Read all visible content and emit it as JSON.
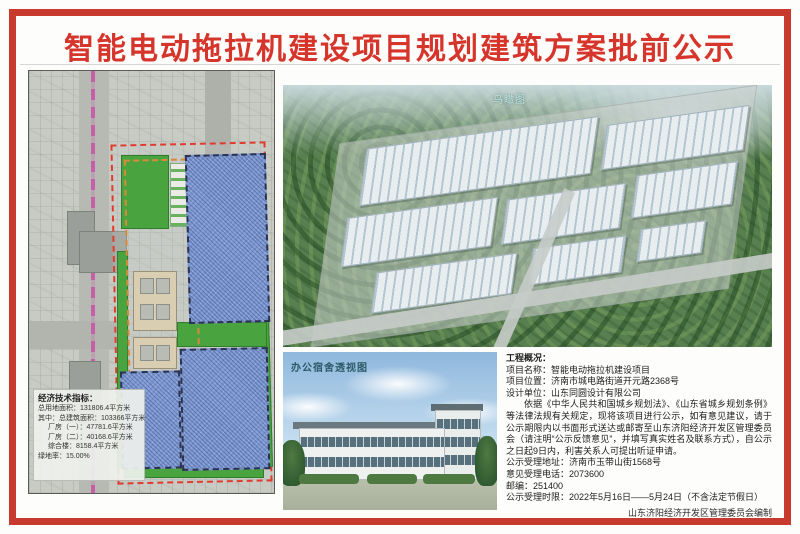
{
  "title": "智能电动拖拉机建设项目规划建筑方案批前公示",
  "site_plan": {
    "legend_title": "经济技术指标：",
    "legend_lines": [
      "总用地面积：131806.4平方米",
      "其中：总建筑面积：103366平方米",
      "厂房（一）：47781.6平方米",
      "厂房（二）：40168.6平方米",
      "综合楼：8158.4平方米",
      "绿地率：15.00%"
    ]
  },
  "aerial": {
    "label": "鸟瞰图"
  },
  "perspective": {
    "label": "办公宿舍透视图"
  },
  "notice": {
    "section_title": "工程概况：",
    "project_name": "项目名称：智能电动拖拉机建设项目",
    "project_location": "项目位置：济南市城电路街道开元路2368号",
    "design_unit": "设计单位：山东同圆设计有限公司",
    "paragraph": "依据《中华人民共和国城乡规划法》、《山东省城乡规划条例》等法律法规有关规定，现将该项目进行公示，如有意见建议，请于公示期限内以书面形式送达或邮寄至山东济阳经济开发区管理委员会（请注明“公示反馈意见”，并填写真实姓名及联系方式），自公示之日起9日内，利害关系人可提出听证申请。",
    "address": "公示受理地址：济南市玉带山街1568号",
    "phone": "意见受理电话：2073600",
    "postcode": "邮编：251400",
    "period": "公示受理时限：2022年5月16日——5月24日（不含法定节假日）",
    "footer": "山东济阳经济开发区管理委员会编制"
  },
  "colors": {
    "border_red": "#c93a2e",
    "title_red": "#d6352b",
    "building_blue": "#7e99d2",
    "greenery": "#49a33f",
    "boundary_red": "#e23b2e",
    "internal_road_orange": "#d88a3c",
    "planned_road_magenta": "#c55fa8"
  }
}
